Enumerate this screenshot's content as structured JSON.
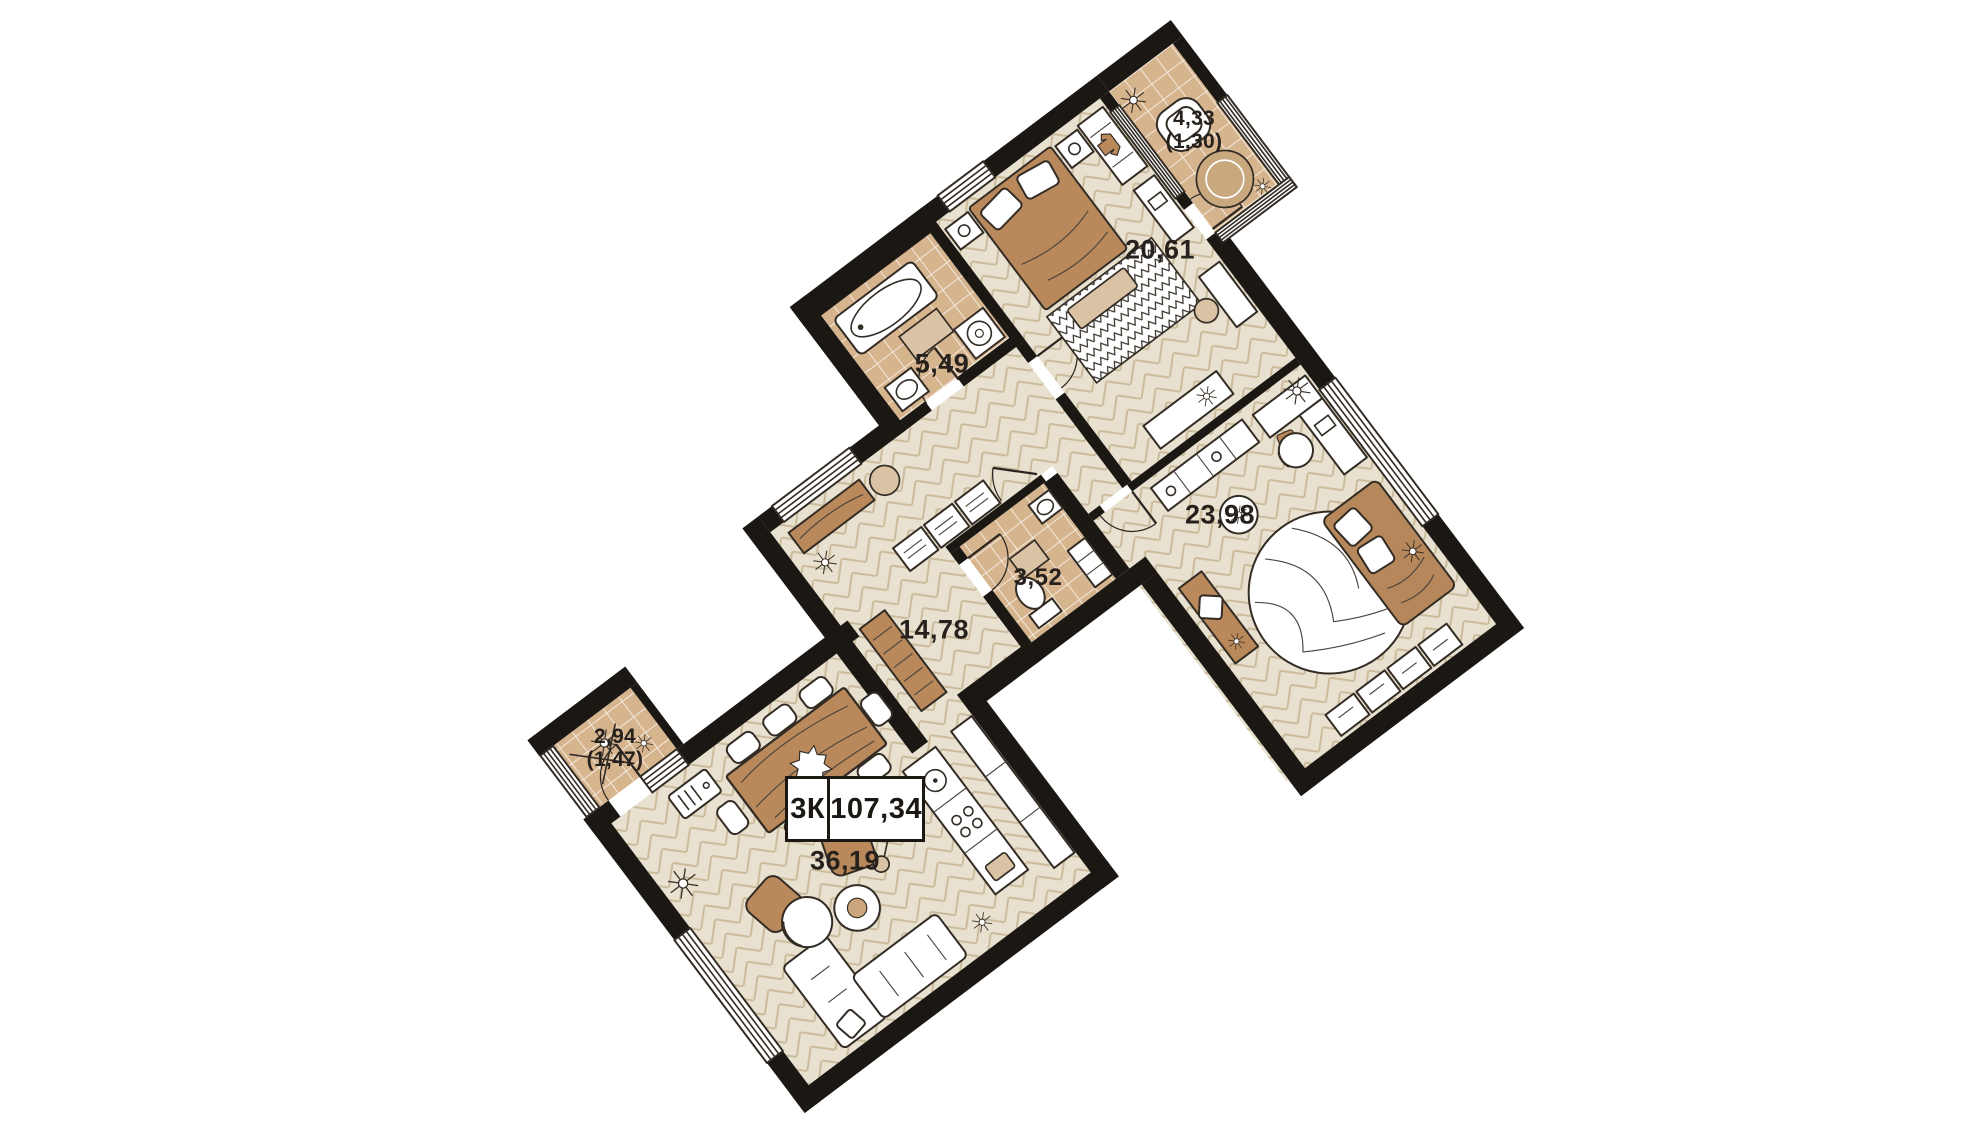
{
  "summary": {
    "rooms_type": "3К",
    "total_area": "107,34"
  },
  "rooms": {
    "bedroom": {
      "area": "20,61"
    },
    "balcony_ne": {
      "area": "4,33",
      "reduced_area": "(1,30)"
    },
    "bathroom": {
      "area": "5,49"
    },
    "study": {
      "area": "23,98"
    },
    "hallway": {
      "area": "14,78"
    },
    "wc": {
      "area": "3,52"
    },
    "kitchen_living": {
      "area": "36,19"
    },
    "balcony_w": {
      "area": "2,94",
      "reduced_area": "(1,47)"
    }
  },
  "colors": {
    "wall": "#1b1713",
    "floor_wood": "#e9e1d0",
    "floor_wood_lines": "#cabb9b",
    "floor_tile": "#d6b58e",
    "furniture_wood": "#b9895c",
    "textile_accent": "#b5875b",
    "label_text": "#26211c",
    "background": "#ffffff"
  }
}
